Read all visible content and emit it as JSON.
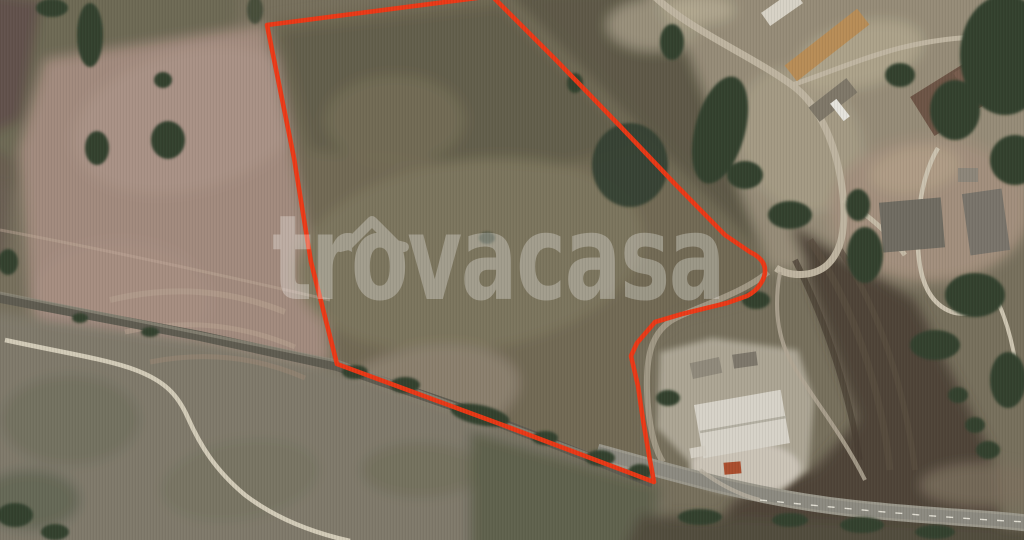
{
  "scene": {
    "type": "satellite-aerial-photo",
    "description": "Aerial view of rural land for sale: red outlined parcel of farmland beside a village, tree-lined road and highway"
  },
  "brand_watermark": {
    "text": "trovacasa",
    "roof_over_letter": "o",
    "color": "#ffffff",
    "opacity": "0.3"
  },
  "property_boundary": {
    "color": "#f23310",
    "stroke_width": "4.6",
    "path": "M 492,-4 L 556,60 L 618,124 L 675,184 L 725,235 L 750,252 Q 769,261 764,277 Q 759,290 747,296 L 727,303 L 682,314 L 655,322 L 637,343 L 631,356 L 638,386 L 643,420 L 649,455 L 654,482 L 500,424 L 337,364 L 311,262 L 294,158 L 267,25 Z"
  }
}
